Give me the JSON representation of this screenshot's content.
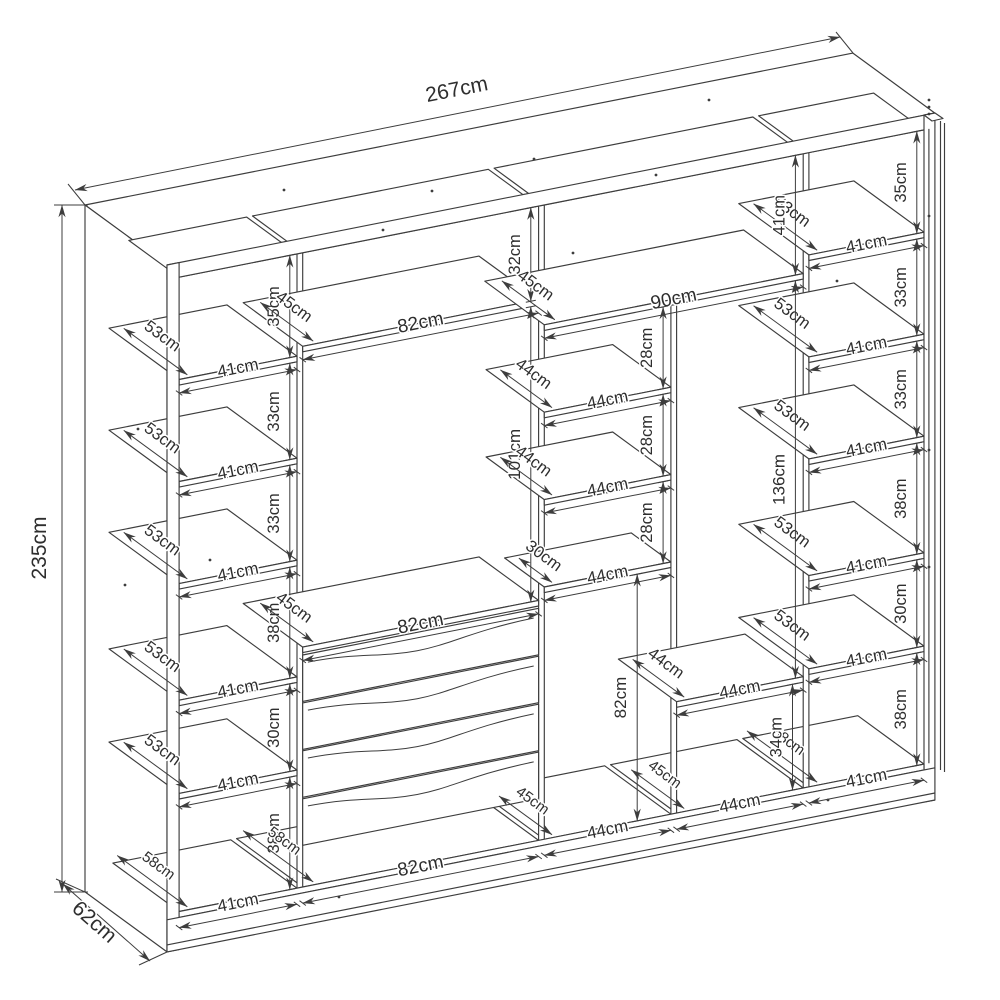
{
  "colors": {
    "line": "#3d3d3d",
    "label": "#2e2e2e",
    "background": "#ffffff"
  },
  "overall": {
    "width": "267cm",
    "height": "235cm",
    "depth": "62cm"
  },
  "left_column": {
    "compartments": [
      {
        "depth": "53cm",
        "width": "41cm",
        "height": "35cm"
      },
      {
        "depth": "53cm",
        "width": "41cm",
        "height": "33cm"
      },
      {
        "depth": "53cm",
        "width": "41cm",
        "height": "33cm"
      },
      {
        "depth": "53cm",
        "width": "41cm",
        "height": "38cm"
      },
      {
        "depth": "53cm",
        "width": "41cm",
        "height": "30cm"
      },
      {
        "depth": "58cm",
        "width": "41cm",
        "height": "38cm"
      }
    ]
  },
  "second_column": {
    "top_gap": "32cm",
    "upper_shelf": {
      "depth": "45cm",
      "width": "82cm"
    },
    "hanging_space": "101cm",
    "lower_shelf": {
      "depth": "45cm",
      "width": "82cm"
    },
    "drawer_count": 4,
    "base": {
      "depth": "58cm",
      "width": "82cm"
    }
  },
  "center_section": {
    "top_gap": "41cm",
    "top_shelf": {
      "depth": "45cm",
      "width": "90cm"
    },
    "left_bay": {
      "shelves": [
        {
          "gap": "28cm",
          "depth": "44cm",
          "width": "44cm"
        },
        {
          "gap": "28cm",
          "depth": "44cm",
          "width": "44cm"
        },
        {
          "gap": "28cm",
          "depth": "30cm",
          "width": "44cm"
        }
      ],
      "hanging_space": "82cm",
      "base": {
        "depth": "45cm",
        "width": "44cm"
      }
    },
    "right_bay": {
      "hanging_space": "136cm",
      "shelf": {
        "depth": "44cm",
        "width": "44cm"
      },
      "gap": "34cm",
      "base": {
        "depth": "45cm",
        "width": "44cm"
      }
    }
  },
  "right_column": {
    "compartments": [
      {
        "depth": "53cm",
        "width": "41cm",
        "height": "35cm"
      },
      {
        "depth": "53cm",
        "width": "41cm",
        "height": "33cm"
      },
      {
        "depth": "53cm",
        "width": "41cm",
        "height": "33cm"
      },
      {
        "depth": "53cm",
        "width": "41cm",
        "height": "38cm"
      },
      {
        "depth": "53cm",
        "width": "41cm",
        "height": "30cm"
      },
      {
        "depth": "58cm",
        "width": "41cm",
        "height": "38cm"
      }
    ]
  }
}
